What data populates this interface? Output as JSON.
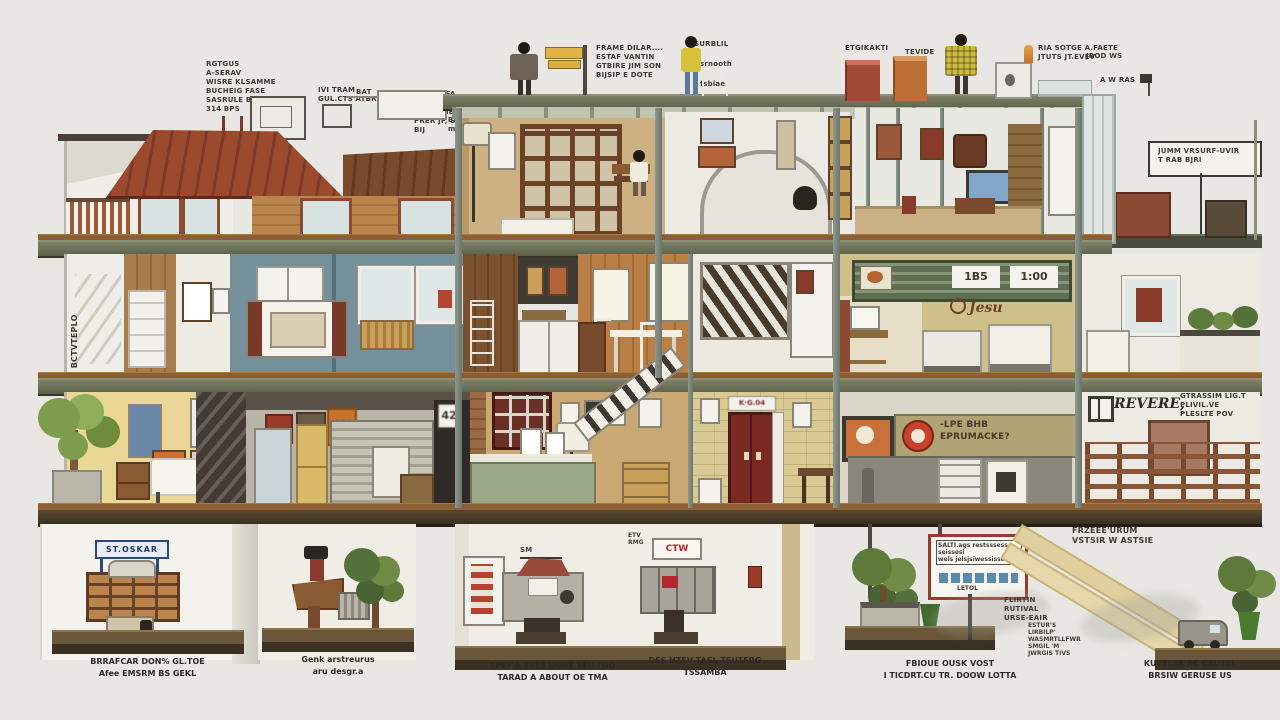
{
  "title": "building-cutaway-infographic",
  "ann": {
    "tl1": "RGTGUS\nA-SERAV\nWISRE KLSAMME\nBUCHEIG FASE\nSASRULE BROSE\n314 BPS",
    "tl2": "IVI TRAM\nGUL.CTS ATBRD----",
    "tl3": "EIT___TIFA\nLVE POLRTARTRET\nLTS RAME JPL.TOU\nPRER JF, SEL\nBIJ",
    "bat": "BAT",
    "balkoni": "BALKONI\nmuseblikler",
    "ses": "ses",
    "plise": "plise",
    "framedilar": "FRAME DILAR....\nESTAF VANTIN\nGTBIRE JIM SON\nBIJSIP E DOTE",
    "surblil": "SURBLIL",
    "srnooth": "srnooth",
    "fsbiae": "fsbiae",
    "etgikakti": "ETGIKAKTI",
    "tevide": "TEVIDE",
    "ria": "RIA SOTGE A.FAETE\nJTUTS JT.EVEV",
    "jrod": "JROD WS",
    "awras": "A W RAS",
    "rightbox": "JUMM  VRSURF-UVIR\nT    RAB BJRI",
    "vleft": "GO ID BCTVTEPLO",
    "revere": "REVERE,",
    "reveresub": "GTRASSIM LIG.T\nPLIVIL.VE\nPLESLTE POV",
    "frzee": "FRZEEE'URUM\nVSTSIR W ASTSIE",
    "flirtin": "FLIRTIN\nRUTIVAL\nURSE-EAIR",
    "estur": "ESTUR'S\nLIRBILP'\nWASMRTLLFWR\nSMGIL 'M\nJWRGIS TIVS",
    "signbox": "SALTI.ags restsssess seissesi\nwels jelsjsiwessisses",
    "signsmall": "LETOL",
    "smlabel": "SM",
    "etv": "ETV\nRMG"
  },
  "signs": {
    "s42": "42",
    "s4": "4%",
    "g1": "1B5",
    "g2": "1:00",
    "jesu": "Jesu",
    "door": "K·G.04",
    "banner": "-LPE BHB\nEPRUMACKE?",
    "oskar": "ST.OSKAR",
    "ctw": "CTW"
  },
  "captions": [
    {
      "text": "BRRAFCAR DON% GL.TOE\nAfee EMSRM BS GEKL"
    },
    {
      "text": "Genk arstreurus\naru desgr.a"
    },
    {
      "text": "EPEF'A TAES UGHT SEU-TGG\nTARAD  A ABOUT OE  TMA"
    },
    {
      "text": "DES HTEV TASL TEUTERG\nTSSAMBA"
    },
    {
      "text": "FBIOUE OUSK VOST\nI TICDRT.CU TR. DOOW LOTTA"
    },
    {
      "text": "KUTTLSE.AC CAUTEL\nBRSIW GERUSE US"
    }
  ],
  "colors": {
    "background": "#e9e7e3",
    "slab": "#666a55",
    "wood_floor": "#8b5e34",
    "teal_wall": "#73909b",
    "yellow_wall": "#ead795",
    "copper_roof": "#9c4a2e",
    "green_sign": "#5f7050",
    "banner_tan": "#b0a477",
    "red_door": "#7a2a22",
    "logo_red": "#c9412a"
  }
}
